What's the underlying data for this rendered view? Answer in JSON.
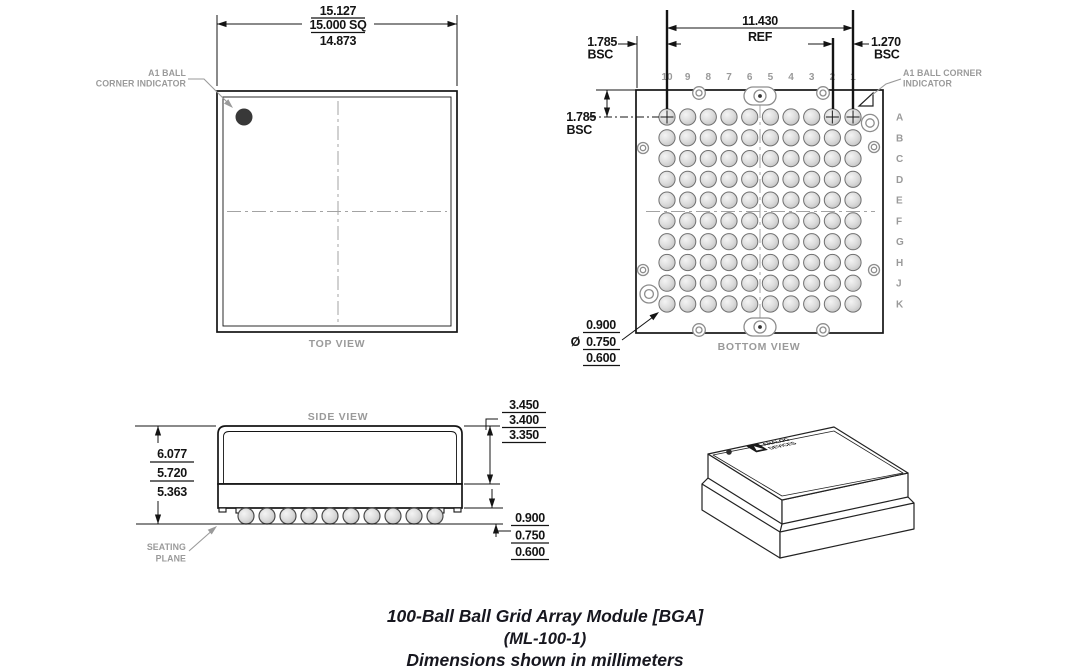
{
  "caption": {
    "line1": "100-Ball Ball Grid Array Module [BGA]",
    "line2": "(ML-100-1)",
    "line3": "Dimensions shown in millimeters"
  },
  "top_view": {
    "label": "TOP VIEW",
    "dim_width": {
      "max": "15.127",
      "nom": "15.000 SQ",
      "min": "14.873"
    },
    "a1_label_line1": "A1 BALL",
    "a1_label_line2": "CORNER INDICATOR"
  },
  "bottom_view": {
    "label": "BOTTOM VIEW",
    "columns": [
      "10",
      "9",
      "8",
      "7",
      "6",
      "5",
      "4",
      "3",
      "2",
      "1"
    ],
    "rows": [
      "A",
      "B",
      "C",
      "D",
      "E",
      "F",
      "G",
      "H",
      "J",
      "K"
    ],
    "crosshair_columns": [
      "10",
      "2",
      "1"
    ],
    "dim_span": {
      "value": "11.430",
      "qualifier": "REF"
    },
    "dim_edge_top": {
      "value": "1.785",
      "qualifier": "BSC"
    },
    "dim_edge_left": {
      "value": "1.785",
      "qualifier": "BSC"
    },
    "dim_pitch": {
      "value": "1.270",
      "qualifier": "BSC"
    },
    "dim_ball_diameter": {
      "symbol": "Ø",
      "max": "0.900",
      "nom": "0.750",
      "min": "0.600"
    },
    "a1_label_line1": "A1 BALL CORNER",
    "a1_label_line2": "INDICATOR"
  },
  "side_view": {
    "label": "SIDE VIEW",
    "dim_height": {
      "max": "6.077",
      "nom": "5.720",
      "min": "5.363"
    },
    "dim_lid": {
      "max": "3.450",
      "nom": "3.400",
      "min": "3.350"
    },
    "dim_standoff": {
      "max": "0.900",
      "nom": "0.750",
      "min": "0.600"
    },
    "seating_plane_line1": "SEATING",
    "seating_plane_line2": "PLANE"
  },
  "iso_view": {
    "logo_line1": "ANALOG",
    "logo_line2": "DEVICES"
  },
  "colors": {
    "line": "#141414",
    "gray_label": "#9a9a9a",
    "centerline": "#a3a3a3",
    "ball_stroke": "#707070",
    "a1_dot": "#383838"
  }
}
